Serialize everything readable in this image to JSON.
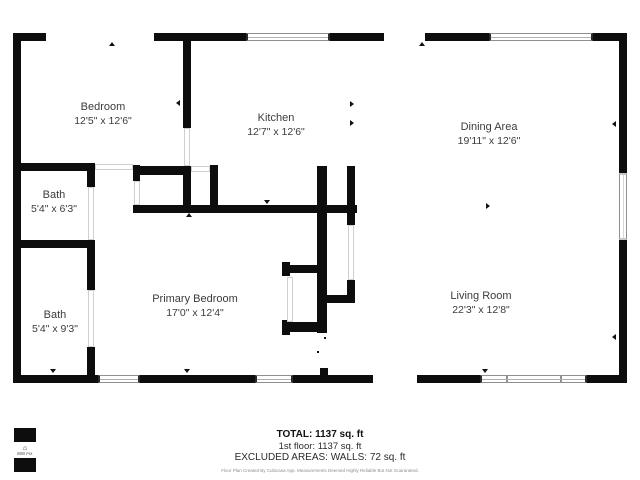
{
  "floor_plan": {
    "rooms": [
      {
        "name": "Bedroom",
        "dimensions": "12'5\" x 12'6\""
      },
      {
        "name": "Kitchen",
        "dimensions": "12'7\" x 12'6\""
      },
      {
        "name": "Dining Area",
        "dimensions": "19'11\" x 12'6\""
      },
      {
        "name": "Bath",
        "dimensions": "5'4\" x 6'3\""
      },
      {
        "name": "Primary Bedroom",
        "dimensions": "17'0\" x 12'4\""
      },
      {
        "name": "Bath",
        "dimensions": "5'4\" x 9'3\""
      },
      {
        "name": "Living Room",
        "dimensions": "22'3\" x 12'8\""
      }
    ],
    "summary": {
      "total": "TOTAL: 1137 sq. ft",
      "first_floor": "1st floor: 1137 sq. ft",
      "excluded": "EXCLUDED AREAS: WALLS: 72 sq. ft",
      "disclaimer": "Floor Plan Created By Cubicasa App. Measurements Deemed Highly Reliable But Not Guaranteed."
    },
    "logo": {
      "text": "PIX",
      "house_icon": "⌂"
    },
    "colors": {
      "wall": "#0d0d0d",
      "text": "#3c3c3c"
    }
  }
}
